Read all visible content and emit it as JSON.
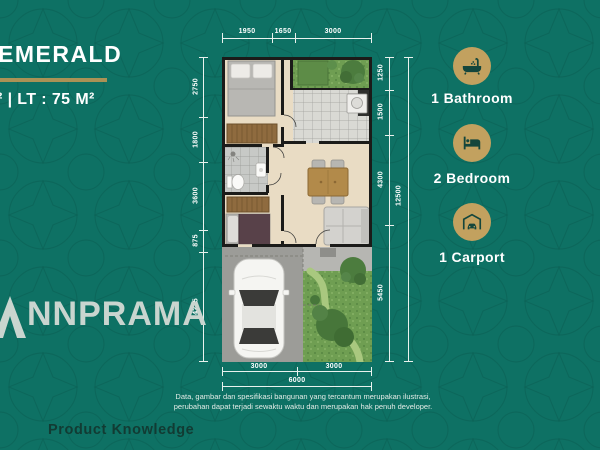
{
  "title": "EMERALD",
  "spec": "² | LT : 75 M²",
  "plan": {
    "dims_top": [
      "1950",
      "1650",
      "3000"
    ],
    "dims_left": [
      "2750",
      "1800",
      "3600",
      "875",
      "4275"
    ],
    "dims_right": [
      "1250",
      "1500",
      "4300",
      "5450"
    ],
    "dim_right_total": "12500",
    "dims_bottom": [
      "3000",
      "3000"
    ],
    "dim_bottom_total": "6000"
  },
  "features": [
    {
      "icon": "bathtub-icon",
      "label": "1 Bathroom"
    },
    {
      "icon": "bed-icon",
      "label": "2 Bedroom"
    },
    {
      "icon": "carport-icon",
      "label": "1 Carport"
    }
  ],
  "logo": {
    "mark": "A",
    "text": "NNPRAMA"
  },
  "disclaimer_line1": "Data, gambar dan spesifikasi bangunan yang tercantum merupakan ilustrasi,",
  "disclaimer_line2": "perubahan dapat terjadi sewaktu waktu dan merupakan hak penuh developer.",
  "footer": "Product Knowledge",
  "colors": {
    "background": "#0e7164",
    "accent_gold": "#c2a15f",
    "icon_glyph": "#14463c",
    "text": "#ffffff",
    "logo_text": "#c9d5cf"
  }
}
